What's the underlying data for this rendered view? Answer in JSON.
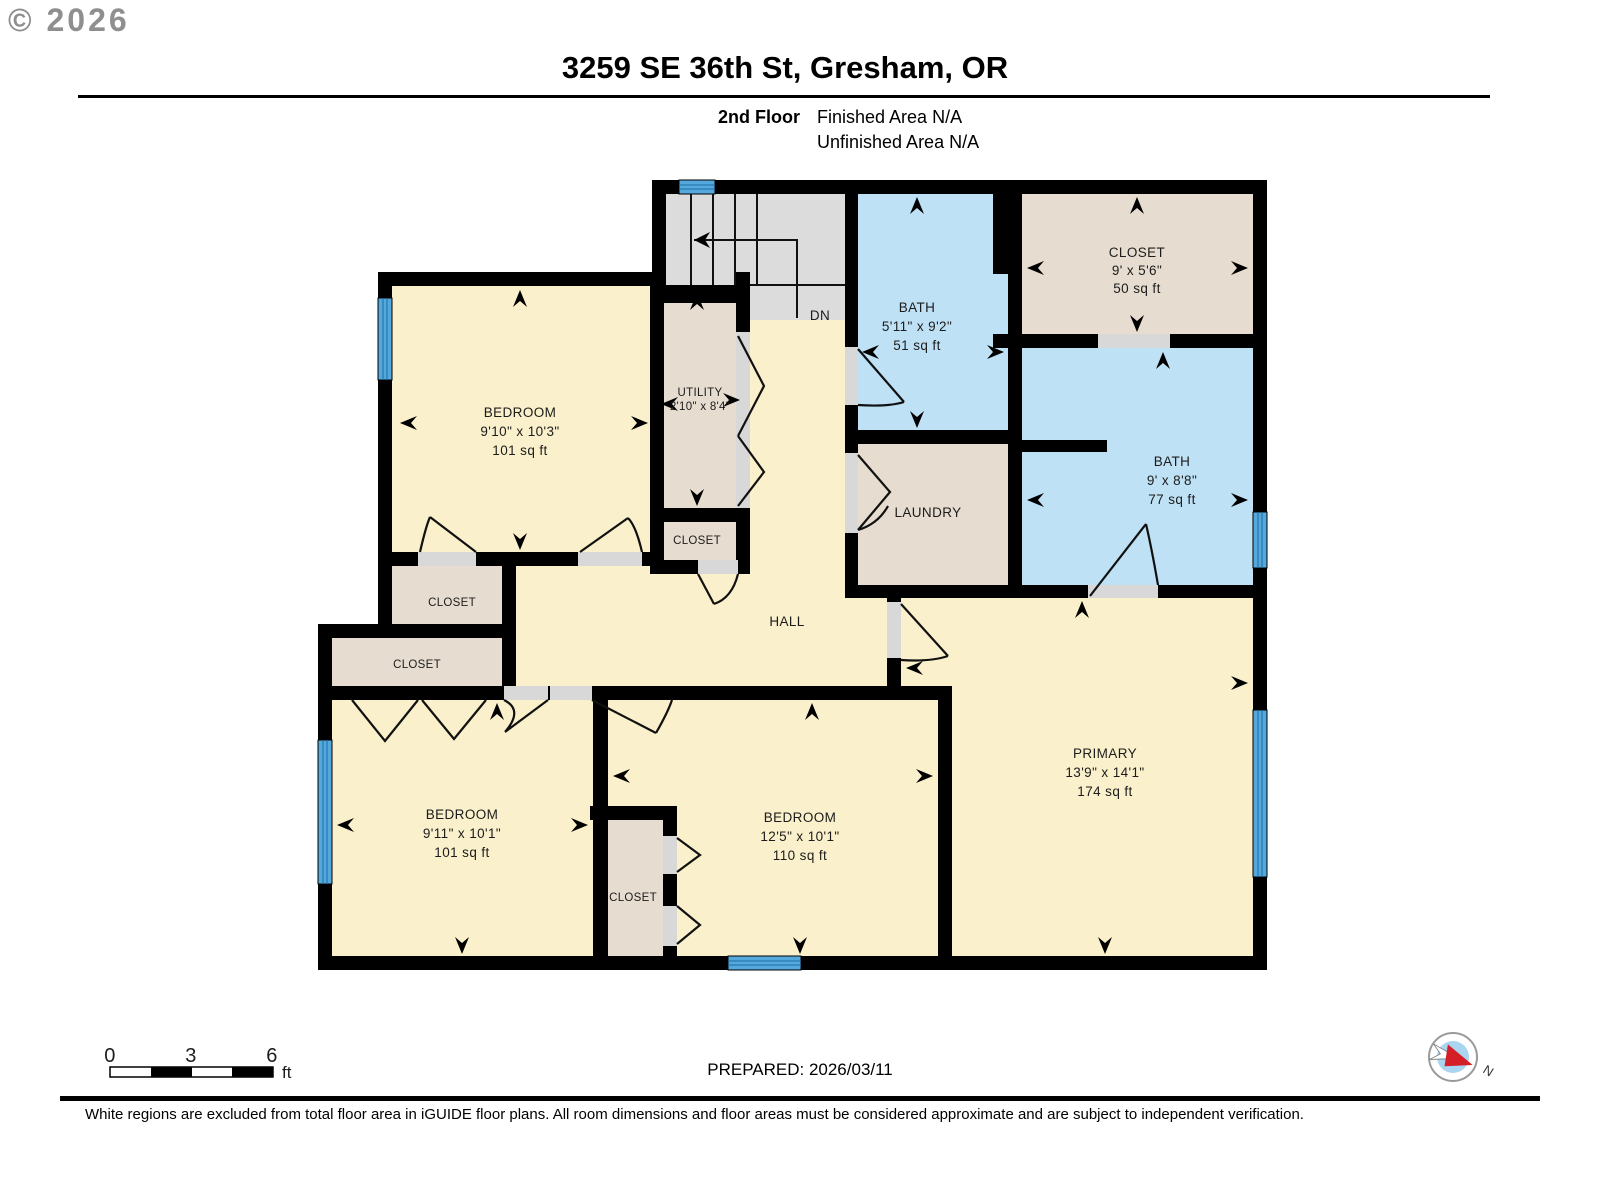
{
  "copyright": "© 2026",
  "header": {
    "title": "3259 SE 36th St, Gresham, OR",
    "floor_label": "2nd Floor",
    "finished_area": "Finished Area N/A",
    "unfinished_area": "Unfinished Area N/A"
  },
  "plan": {
    "stairs_label": "DN",
    "rooms": {
      "bedroom_tl": {
        "name": "BEDROOM",
        "dims": "9'10\" x 10'3\"",
        "area": "101 sq ft"
      },
      "utility": {
        "name": "UTILITY",
        "dims": "2'10\" x 8'4\""
      },
      "closet_utility": {
        "name": "CLOSET"
      },
      "bath_top": {
        "name": "BATH",
        "dims": "5'11\" x 9'2\"",
        "area": "51 sq ft"
      },
      "closet_top_right": {
        "name": "CLOSET",
        "dims": "9' x 5'6\"",
        "area": "50 sq ft"
      },
      "bath_right": {
        "name": "BATH",
        "dims": "9' x 8'8\"",
        "area": "77 sq ft"
      },
      "laundry": {
        "name": "LAUNDRY"
      },
      "hall": {
        "name": "HALL"
      },
      "closet_left_upper": {
        "name": "CLOSET"
      },
      "closet_left_lower": {
        "name": "CLOSET"
      },
      "bedroom_bl": {
        "name": "BEDROOM",
        "dims": "9'11\" x 10'1\"",
        "area": "101 sq ft"
      },
      "closet_bottom_mid": {
        "name": "CLOSET"
      },
      "bedroom_bm": {
        "name": "BEDROOM",
        "dims": "12'5\" x 10'1\"",
        "area": "110 sq ft"
      },
      "primary": {
        "name": "PRIMARY",
        "dims": "13'9\" x 14'1\"",
        "area": "174 sq ft"
      }
    }
  },
  "scale_bar": {
    "tick_0": "0",
    "tick_3": "3",
    "tick_6": "6",
    "unit": "ft"
  },
  "footer": {
    "prepared": "PREPARED: 2026/03/11",
    "disclaimer": "White regions are excluded from total floor area in iGUIDE floor plans. All room dimensions and floor areas must be considered approximate and are subject to independent verification.",
    "compass_north": "N"
  },
  "colors": {
    "room_finished": "#FAF0CB",
    "room_excluded": "#E6DDD0",
    "room_bath": "#BFE1F5",
    "stairs": "#DCDCDC",
    "window": "#54A8DB",
    "wall": "#000000"
  }
}
